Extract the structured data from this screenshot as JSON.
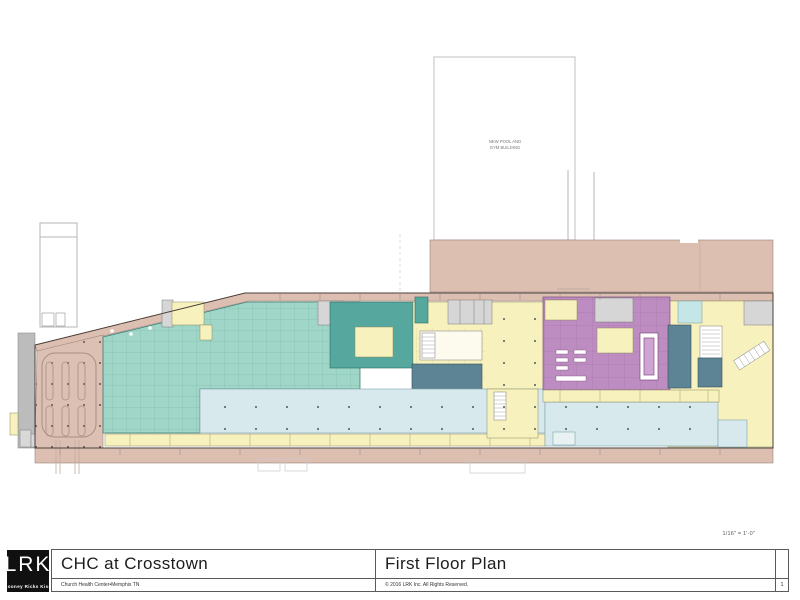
{
  "sheet": {
    "scale_note": "1/16\" = 1'-0\"",
    "sheet_number": "1"
  },
  "title_block": {
    "logo": {
      "monogram": "LRK",
      "firm_name": "Looney Ricks Kiss"
    },
    "project_title": "CHC at Crosstown",
    "project_subtitle": "Church Health Center•Memphis TN",
    "drawing_title": "First Floor Plan",
    "copyright": "© 2016 LRK Inc. All Rights Reserved."
  },
  "plan": {
    "annotations": {
      "pool_building_label_line1": "NEW POOL AND",
      "pool_building_label_line2": "GYM BUILDING"
    },
    "zone_colors": {
      "existing": "#ddbfb2",
      "parking": "#dcc0b4",
      "teal": "#9fd6c7",
      "dark_teal": "#56a89f",
      "yellow": "#f7f1bd",
      "purple": "#bd8cc0",
      "corridor": "#d7e9ec",
      "slate": "#5d8495",
      "grey_rooms": "#d6d6d6",
      "site_grey": "#bcbcbc",
      "cyan_room": "#c5e6e6"
    }
  }
}
